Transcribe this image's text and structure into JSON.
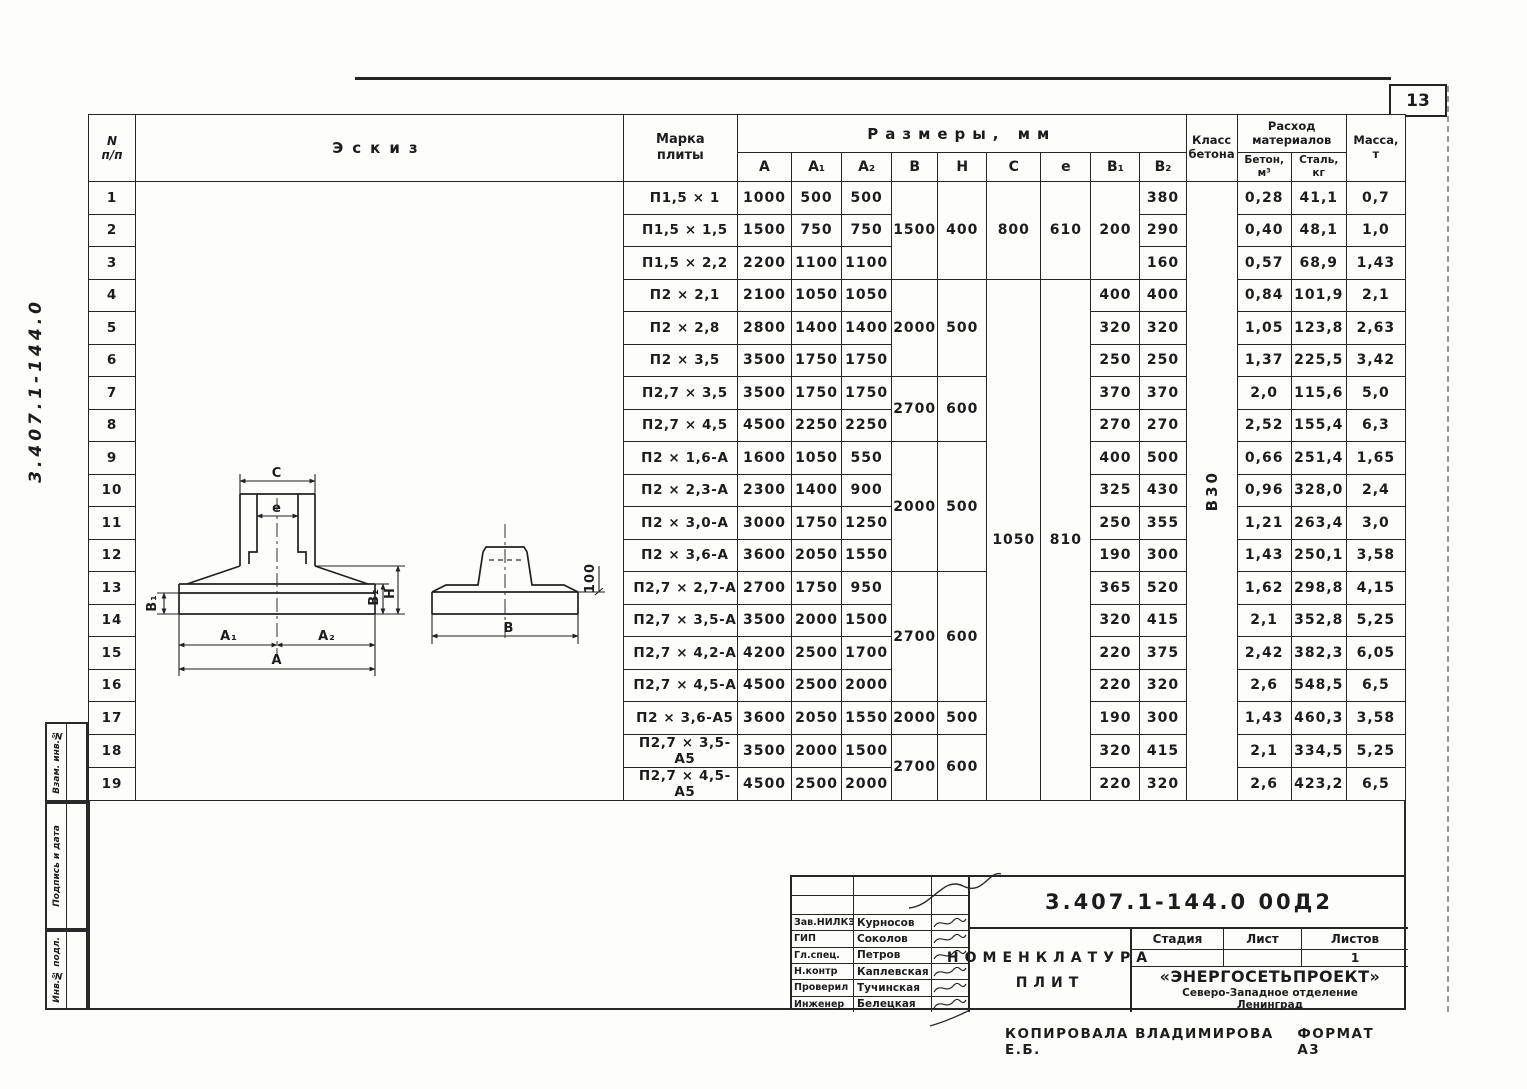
{
  "page": {
    "sheet_number": "13",
    "side_code": "3.407.1-144.0",
    "footer_copied": "Копировала  Владимирова Е.Б.",
    "footer_format": "Формат А3"
  },
  "stamps_left": {
    "box1": "Взам. инв.№",
    "box2": "Подпись и дата",
    "box3": "Инв.№ подл."
  },
  "table": {
    "col_headers": {
      "num1": "N",
      "num2": "п/п",
      "sketch": "Эскиз",
      "mark1": "Марка",
      "mark2": "плиты",
      "sizes": "Размеры,  мм",
      "size_cols": [
        "А",
        "А₁",
        "А₂",
        "В",
        "Н",
        "С",
        "е",
        "В₁",
        "В₂"
      ],
      "class1": "Класс",
      "class2": "бетона",
      "mat1": "Расход",
      "mat2": "материалов",
      "mat_concrete1": "Бетон,",
      "mat_concrete2": "м³",
      "mat_steel1": "Сталь,",
      "mat_steel2": "кг",
      "mass1": "Масса,",
      "mass2": "т"
    },
    "concrete_class_value": "В30",
    "rows": [
      {
        "n": "1",
        "mark": "П1,5 × 1",
        "a": "1000",
        "a1": "500",
        "a2": "500",
        "bh": {
          "b": "1500",
          "h": "400",
          "span": 3
        },
        "ce": {
          "c": "800",
          "e": "610",
          "span": 3
        },
        "b1": {
          "v": "200",
          "span": 3
        },
        "b2": "380",
        "concrete": "0,28",
        "steel": "41,1",
        "mass": "0,7"
      },
      {
        "n": "2",
        "mark": "П1,5 × 1,5",
        "a": "1500",
        "a1": "750",
        "a2": "750",
        "b2": "290",
        "concrete": "0,40",
        "steel": "48,1",
        "mass": "1,0"
      },
      {
        "n": "3",
        "mark": "П1,5 × 2,2",
        "a": "2200",
        "a1": "1100",
        "a2": "1100",
        "b2": "160",
        "concrete": "0,57",
        "steel": "68,9",
        "mass": "1,43"
      },
      {
        "n": "4",
        "mark": "П2 × 2,1",
        "a": "2100",
        "a1": "1050",
        "a2": "1050",
        "bh": {
          "b": "2000",
          "h": "500",
          "span": 3
        },
        "ce": {
          "c": "1050",
          "e": "810",
          "span": 16
        },
        "b1": "400",
        "b2": "400",
        "concrete": "0,84",
        "steel": "101,9",
        "mass": "2,1"
      },
      {
        "n": "5",
        "mark": "П2 × 2,8",
        "a": "2800",
        "a1": "1400",
        "a2": "1400",
        "b1": "320",
        "b2": "320",
        "concrete": "1,05",
        "steel": "123,8",
        "mass": "2,63"
      },
      {
        "n": "6",
        "mark": "П2 × 3,5",
        "a": "3500",
        "a1": "1750",
        "a2": "1750",
        "b1": "250",
        "b2": "250",
        "concrete": "1,37",
        "steel": "225,5",
        "mass": "3,42"
      },
      {
        "n": "7",
        "mark": "П2,7 × 3,5",
        "a": "3500",
        "a1": "1750",
        "a2": "1750",
        "bh": {
          "b": "2700",
          "h": "600",
          "span": 2
        },
        "b1": "370",
        "b2": "370",
        "concrete": "2,0",
        "steel": "115,6",
        "mass": "5,0"
      },
      {
        "n": "8",
        "mark": "П2,7 × 4,5",
        "a": "4500",
        "a1": "2250",
        "a2": "2250",
        "b1": "270",
        "b2": "270",
        "concrete": "2,52",
        "steel": "155,4",
        "mass": "6,3"
      },
      {
        "n": "9",
        "mark": "П2 × 1,6-А",
        "a": "1600",
        "a1": "1050",
        "a2": "550",
        "bh": {
          "b": "2000",
          "h": "500",
          "span": 4
        },
        "b1": "400",
        "b2": "500",
        "concrete": "0,66",
        "steel": "251,4",
        "mass": "1,65"
      },
      {
        "n": "10",
        "mark": "П2 × 2,3-А",
        "a": "2300",
        "a1": "1400",
        "a2": "900",
        "b1": "325",
        "b2": "430",
        "concrete": "0,96",
        "steel": "328,0",
        "mass": "2,4"
      },
      {
        "n": "11",
        "mark": "П2 × 3,0-А",
        "a": "3000",
        "a1": "1750",
        "a2": "1250",
        "b1": "250",
        "b2": "355",
        "concrete": "1,21",
        "steel": "263,4",
        "mass": "3,0"
      },
      {
        "n": "12",
        "mark": "П2 × 3,6-А",
        "a": "3600",
        "a1": "2050",
        "a2": "1550",
        "b1": "190",
        "b2": "300",
        "concrete": "1,43",
        "steel": "250,1",
        "mass": "3,58"
      },
      {
        "n": "13",
        "mark": "П2,7 × 2,7-А",
        "a": "2700",
        "a1": "1750",
        "a2": "950",
        "bh": {
          "b": "2700",
          "h": "600",
          "span": 4
        },
        "b1": "365",
        "b2": "520",
        "concrete": "1,62",
        "steel": "298,8",
        "mass": "4,15"
      },
      {
        "n": "14",
        "mark": "П2,7 × 3,5-А",
        "a": "3500",
        "a1": "2000",
        "a2": "1500",
        "b1": "320",
        "b2": "415",
        "concrete": "2,1",
        "steel": "352,8",
        "mass": "5,25"
      },
      {
        "n": "15",
        "mark": "П2,7 × 4,2-А",
        "a": "4200",
        "a1": "2500",
        "a2": "1700",
        "b1": "220",
        "b2": "375",
        "concrete": "2,42",
        "steel": "382,3",
        "mass": "6,05"
      },
      {
        "n": "16",
        "mark": "П2,7 × 4,5-А",
        "a": "4500",
        "a1": "2500",
        "a2": "2000",
        "b1": "220",
        "b2": "320",
        "concrete": "2,6",
        "steel": "548,5",
        "mass": "6,5"
      },
      {
        "n": "17",
        "mark": "П2 × 3,6-А5",
        "a": "3600",
        "a1": "2050",
        "a2": "1550",
        "bh": {
          "b": "2000",
          "h": "500",
          "span": 1
        },
        "b1": "190",
        "b2": "300",
        "concrete": "1,43",
        "steel": "460,3",
        "mass": "3,58"
      },
      {
        "n": "18",
        "mark": "П2,7 × 3,5-А5",
        "a": "3500",
        "a1": "2000",
        "a2": "1500",
        "bh": {
          "b": "2700",
          "h": "600",
          "span": 2
        },
        "b1": "320",
        "b2": "415",
        "concrete": "2,1",
        "steel": "334,5",
        "mass": "5,25"
      },
      {
        "n": "19",
        "mark": "П2,7 × 4,5-А5",
        "a": "4500",
        "a1": "2500",
        "a2": "2000",
        "b1": "220",
        "b2": "320",
        "concrete": "2,6",
        "steel": "423,2",
        "mass": "6,5"
      }
    ]
  },
  "sketch": {
    "labels": {
      "c": "С",
      "e": "е",
      "b1": "В₁",
      "b2": "В₂",
      "h": "Н",
      "a1": "А₁",
      "a2": "А₂",
      "a": "А",
      "b": "В",
      "edge": "100"
    }
  },
  "titleblock": {
    "doc_number": "3.407.1-144.0   00Д2",
    "title_line1": "Номенклатура",
    "title_line2": "плит",
    "signers": [
      {
        "role": "Зав.НИЛКЭ",
        "name": "Курносов"
      },
      {
        "role": "ГИП",
        "name": "Соколов"
      },
      {
        "role": "Гл.спец.",
        "name": "Петров"
      },
      {
        "role": "Н.контр",
        "name": "Каплевская"
      },
      {
        "role": "Проверил",
        "name": "Тучинская"
      },
      {
        "role": "Инженер",
        "name": "Белецкая"
      }
    ],
    "stage_label": "Стадия",
    "sheet_label": "Лист",
    "sheets_label": "Листов",
    "sheets_value": "1",
    "org_name": "«Энергосетьпроект»",
    "org_branch": "Северо-Западное отделение",
    "org_city": "Ленинград"
  }
}
